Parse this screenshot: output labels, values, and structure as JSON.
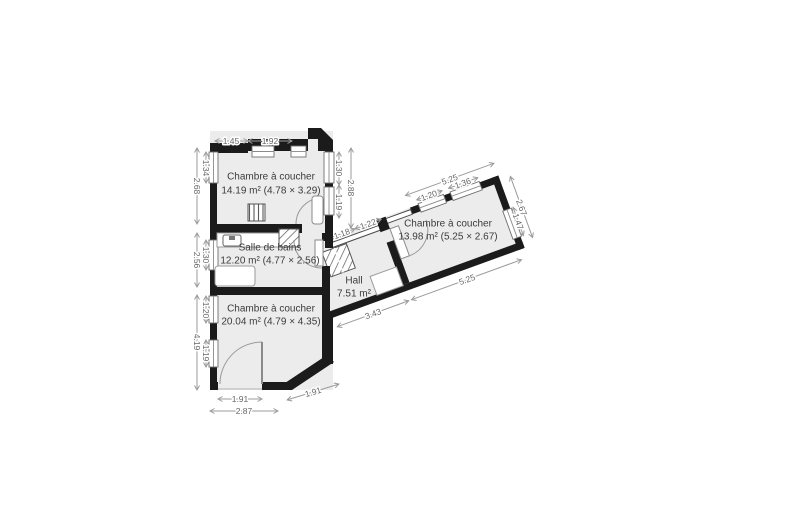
{
  "rooms": {
    "bedroom_top": {
      "name": "Chambre à coucher",
      "area": "14.19 m² (4.78 × 3.29)"
    },
    "bathroom": {
      "name": "Salle de bains",
      "area": "12.20 m² (4.77 × 2.56)"
    },
    "bedroom_bottom": {
      "name": "Chambre à coucher",
      "area": "20.04 m² (4.79 × 4.35)"
    },
    "hall": {
      "name": "Hall",
      "area": "7.51 m²"
    },
    "bedroom_right": {
      "name": "Chambre à coucher",
      "area": "13.98 m² (5.25 × 2.67)"
    }
  },
  "dims": {
    "top_left": "1.45",
    "top_right": "1.92",
    "left_b1_outer": "2.68",
    "left_b1_inner": "1.34",
    "left_bath_outer": "2.56",
    "left_bath_inner": "1.30",
    "left_b2_outer": "4.19",
    "left_b2_inner_top": "1.20",
    "left_b2_inner_bottom": "1.19",
    "right_b1_inner_top": "1.30",
    "right_b1_inner_bottom": "1.19",
    "right_b1_outer": "2.88",
    "bottom_door": "1.91",
    "bottom_angled": "1.91",
    "bottom_outer": "2.87",
    "hall_top_left": "1.18",
    "hall_top_right": "1.22",
    "wing_top_outer": "5.25",
    "wing_top_win1": "1.20",
    "wing_top_win2": "1.36",
    "wing_right_outer": "2.67",
    "wing_right_inner": "1.47",
    "wing_bottom_outer": "5.25",
    "hall_bottom": "3.43"
  },
  "colors": {
    "floor": "#ececec",
    "wall": "#1b1b1b",
    "dim_line": "#9b9b9b",
    "dim_text": "#666666",
    "room_text": "#3b3b3b",
    "background": "#ffffff"
  }
}
